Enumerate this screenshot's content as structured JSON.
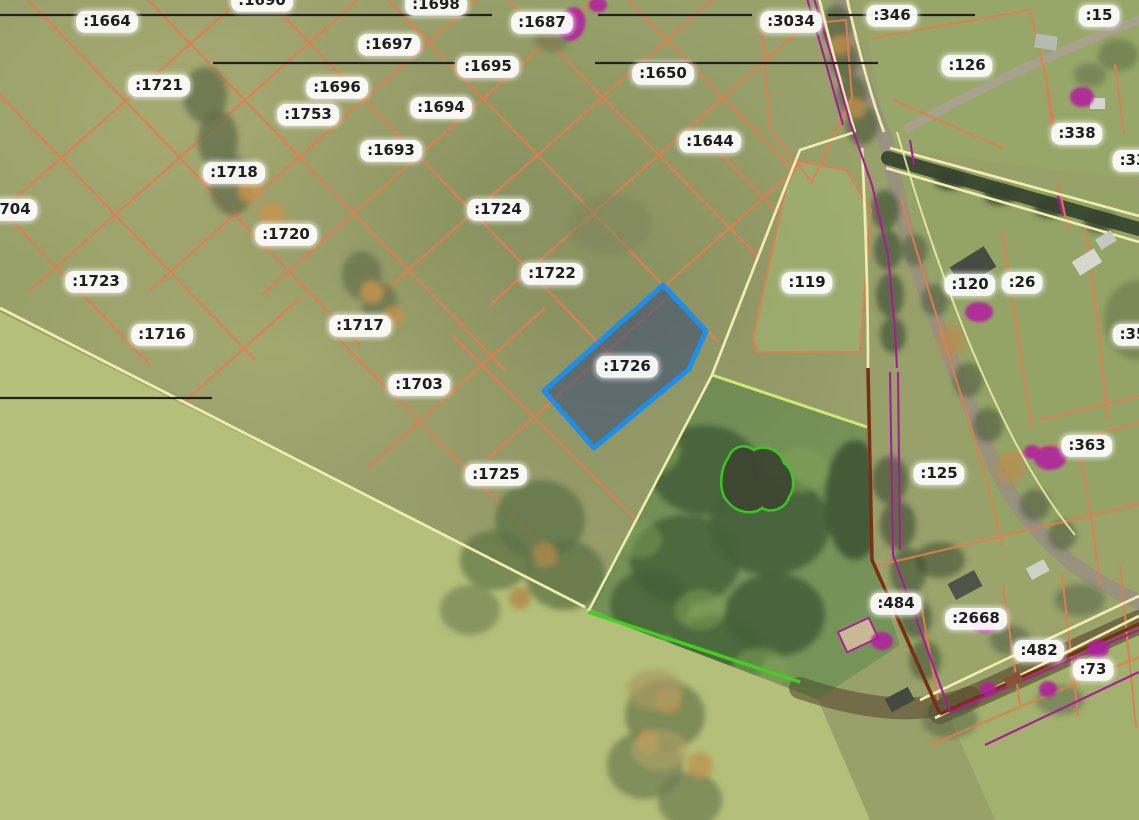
{
  "map": {
    "description": "Aerial cadastral map with land parcel boundaries and parcel number labels",
    "selected_parcel_id": ":1726",
    "colors": {
      "parcel_line_orange": "#dd8050",
      "boundary_yellow": "#f1edb0",
      "selection_blue": "#1d8fe8",
      "selection_fill": "rgba(42,62,120,0.48)",
      "forest_outline_green": "#3fd11c",
      "utility_magenta": "#ab1b97",
      "settlement_maroon": "#7a2f15",
      "annotation_black": "#222222",
      "label_background": "#ffffff",
      "label_text": "#1e1e1e"
    },
    "parcel_labels": [
      {
        "id": ":1690",
        "x": 262,
        "y": 1
      },
      {
        "id": ":1698",
        "x": 436,
        "y": 5
      },
      {
        "id": ":1664",
        "x": 107,
        "y": 22
      },
      {
        "id": ":1687",
        "x": 542,
        "y": 23
      },
      {
        "id": ":3034",
        "x": 791,
        "y": 22
      },
      {
        "id": ":346",
        "x": 892,
        "y": 16
      },
      {
        "id": ":15",
        "x": 1099,
        "y": 16
      },
      {
        "id": ":1697",
        "x": 389,
        "y": 45
      },
      {
        "id": ":1695",
        "x": 488,
        "y": 67
      },
      {
        "id": ":1650",
        "x": 663,
        "y": 74
      },
      {
        "id": ":126",
        "x": 967,
        "y": 66
      },
      {
        "id": ":1721",
        "x": 159,
        "y": 86
      },
      {
        "id": ":1696",
        "x": 337,
        "y": 88
      },
      {
        "id": ":1694",
        "x": 441,
        "y": 108
      },
      {
        "id": ":1753",
        "x": 308,
        "y": 115
      },
      {
        "id": ":338",
        "x": 1077,
        "y": 134
      },
      {
        "id": ":1693",
        "x": 391,
        "y": 151
      },
      {
        "id": ":1644",
        "x": 710,
        "y": 142
      },
      {
        "id": ":33",
        "x": 1133,
        "y": 161
      },
      {
        "id": ":1718",
        "x": 234,
        "y": 173
      },
      {
        "id": "704",
        "x": 15,
        "y": 210
      },
      {
        "id": ":1724",
        "x": 498,
        "y": 210
      },
      {
        "id": ":1720",
        "x": 286,
        "y": 235
      },
      {
        "id": ":1722",
        "x": 552,
        "y": 274
      },
      {
        "id": ":1723",
        "x": 96,
        "y": 282
      },
      {
        "id": ":119",
        "x": 807,
        "y": 283
      },
      {
        "id": ":120",
        "x": 970,
        "y": 285
      },
      {
        "id": ":26",
        "x": 1022,
        "y": 283
      },
      {
        "id": ":1717",
        "x": 360,
        "y": 326
      },
      {
        "id": ":1716",
        "x": 162,
        "y": 335
      },
      {
        "id": ":35",
        "x": 1133,
        "y": 335
      },
      {
        "id": ":1726",
        "x": 627,
        "y": 367
      },
      {
        "id": ":1703",
        "x": 419,
        "y": 385
      },
      {
        "id": ":363",
        "x": 1087,
        "y": 446
      },
      {
        "id": ":125",
        "x": 939,
        "y": 474
      },
      {
        "id": ":1725",
        "x": 496,
        "y": 475
      },
      {
        "id": ":484",
        "x": 896,
        "y": 604
      },
      {
        "id": ":2668",
        "x": 976,
        "y": 619
      },
      {
        "id": ":482",
        "x": 1039,
        "y": 651
      },
      {
        "id": ":73",
        "x": 1093,
        "y": 670
      }
    ]
  }
}
